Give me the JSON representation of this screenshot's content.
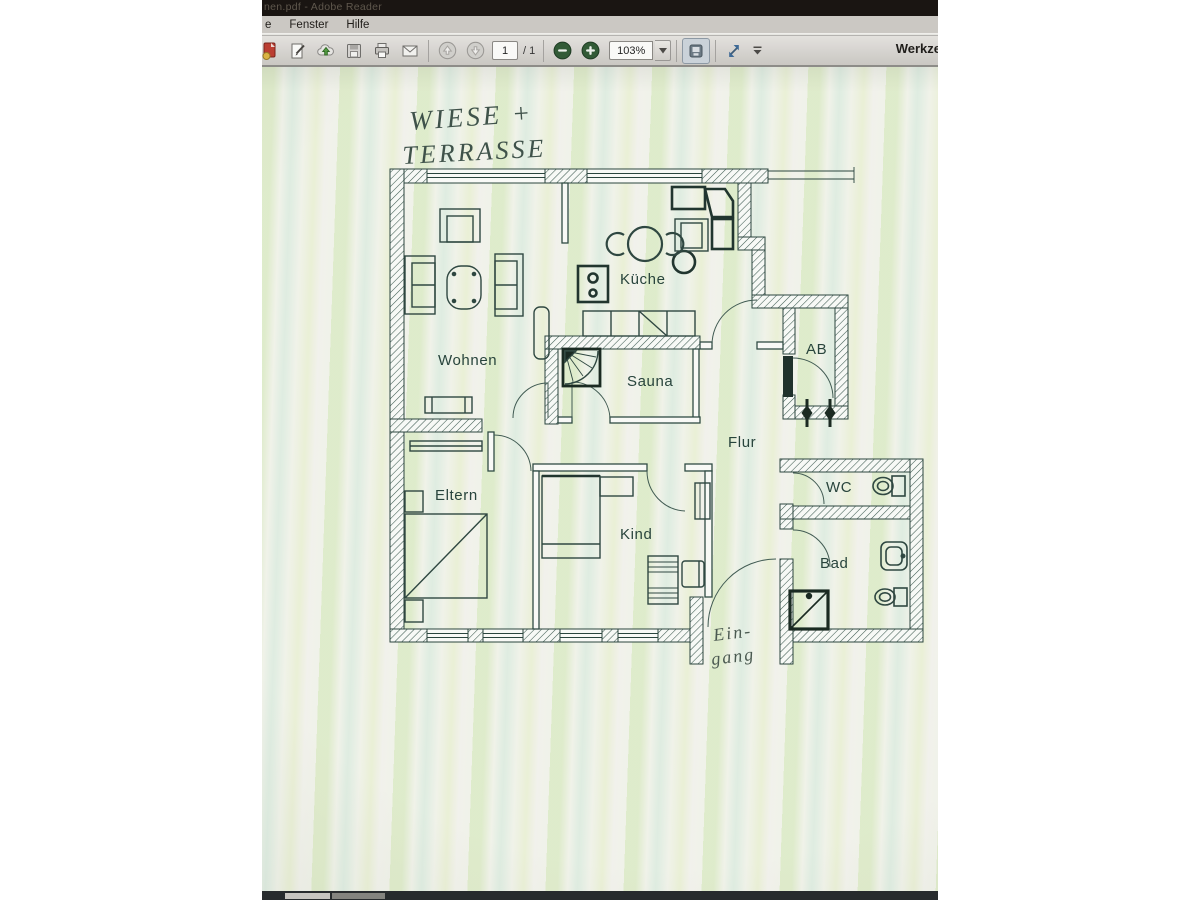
{
  "window": {
    "title": "nen.pdf - Adobe Reader",
    "menu": {
      "items": [
        {
          "label": "e"
        },
        {
          "label": "Fenster"
        },
        {
          "label": "Hilfe"
        }
      ]
    },
    "toolbar": {
      "page_current": "1",
      "page_total_label": "/ 1",
      "zoom_value": "103%",
      "tools_button": "Werkze",
      "icons": [
        "open-document",
        "sign-document",
        "upload-cloud",
        "save",
        "print",
        "email",
        "previous-page",
        "next-page",
        "zoom-out",
        "zoom-in",
        "page-display-mode",
        "fit-window",
        "toolbar-overflow"
      ]
    }
  },
  "plan": {
    "handwriting": {
      "meadow_line1": "WIESE +",
      "meadow_line2": "TERRASSE",
      "entrance_line1": "Ein-",
      "entrance_line2": "gang"
    },
    "rooms": {
      "wohnen": "Wohnen",
      "kueche": "Küche",
      "sauna": "Sauna",
      "ab": "AB",
      "flur": "Flur",
      "eltern": "Eltern",
      "kind": "Kind",
      "wc": "WC",
      "bad": "Bad"
    }
  },
  "colors": {
    "zoom_button_green": "#2e5b33",
    "plan_ink": "#2a473f",
    "titlebar_bg": "#17120e"
  }
}
